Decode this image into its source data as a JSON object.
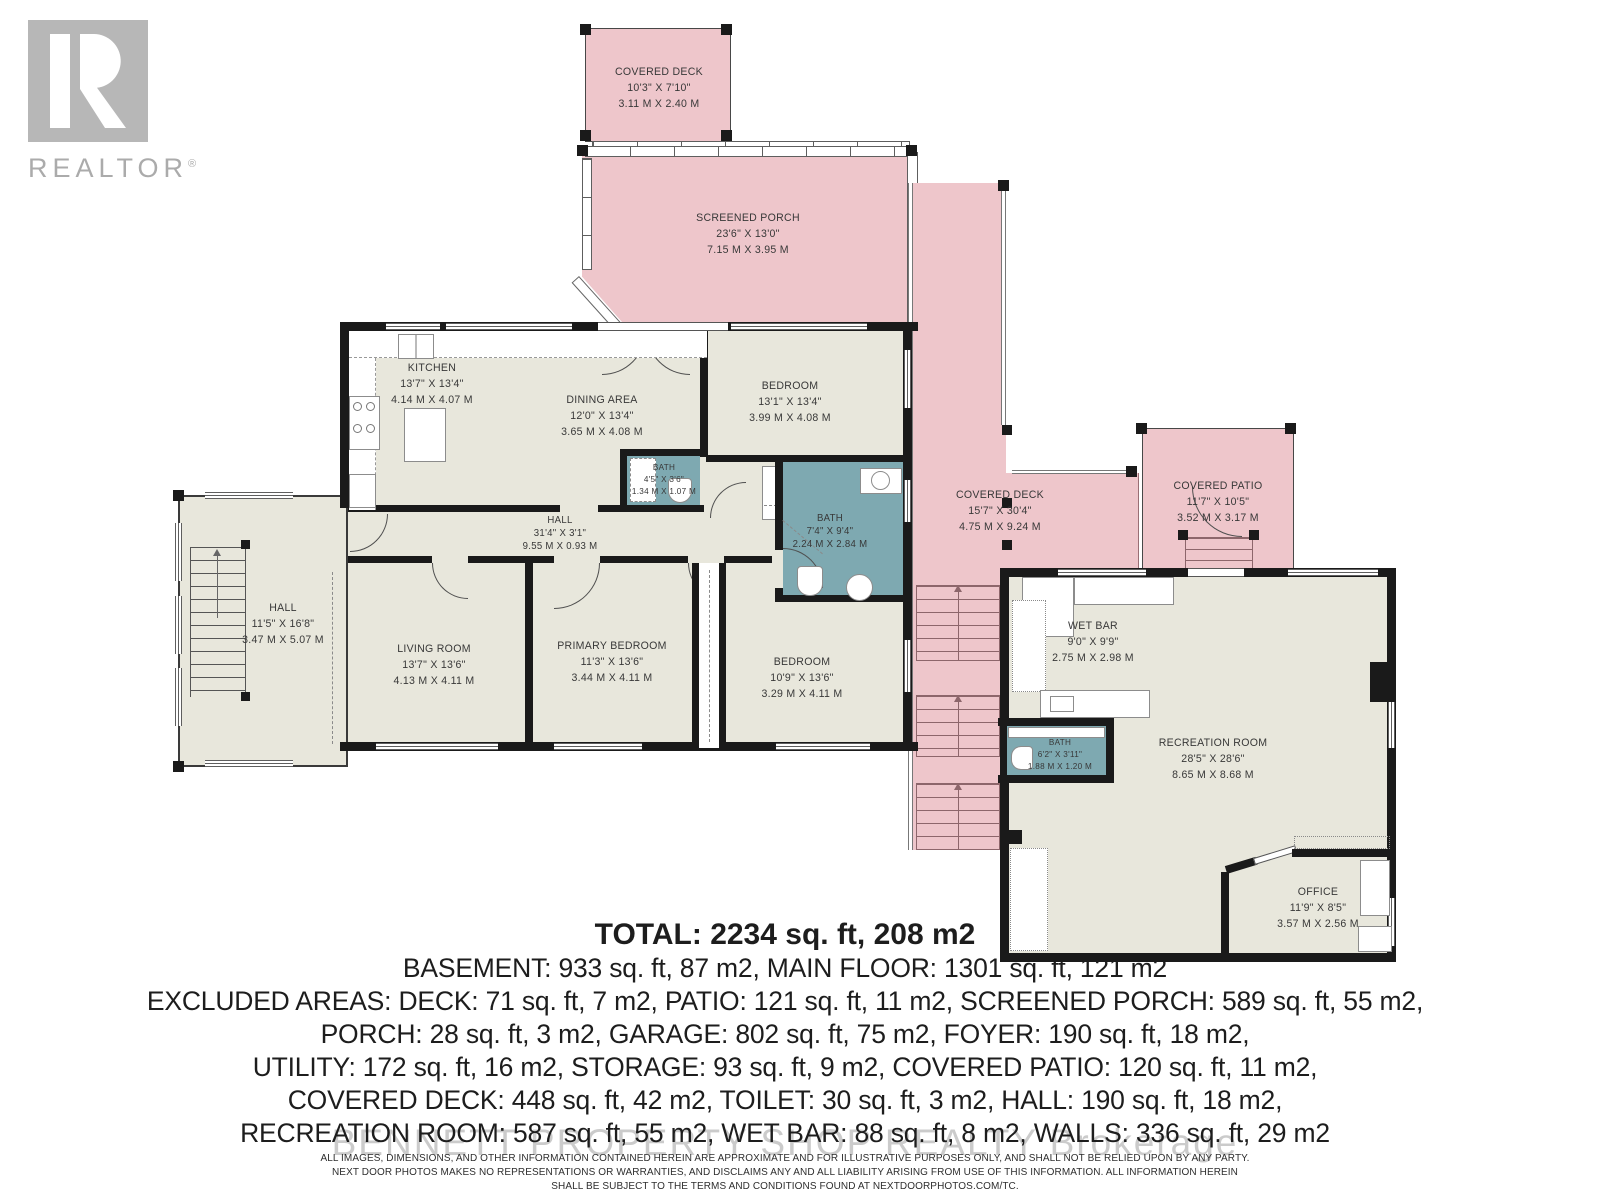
{
  "branding": {
    "logo_text": "REALTOR",
    "logo_reg": "®",
    "watermark": "BENNETT PROPERTY SHOP REALTY  Brokerage"
  },
  "colors": {
    "outdoor_pink": "#eec6cb",
    "interior_beige": "#e8e7dc",
    "bath_teal": "#7ea9b1",
    "wall_black": "#1a1a1a"
  },
  "rooms": {
    "covered_deck_top": {
      "name": "COVERED DECK",
      "dims_ft": "10'3\" X 7'10\"",
      "dims_m": "3.11 M X 2.40 M"
    },
    "screened_porch": {
      "name": "SCREENED PORCH",
      "dims_ft": "23'6\" X 13'0\"",
      "dims_m": "7.15 M X 3.95 M"
    },
    "kitchen": {
      "name": "KITCHEN",
      "dims_ft": "13'7\" X 13'4\"",
      "dims_m": "4.14 M X 4.07 M"
    },
    "dining_area": {
      "name": "DINING AREA",
      "dims_ft": "12'0\" X 13'4\"",
      "dims_m": "3.65 M X 4.08 M"
    },
    "bedroom_top": {
      "name": "BEDROOM",
      "dims_ft": "13'1\" X 13'4\"",
      "dims_m": "3.99 M X 4.08 M"
    },
    "bath_small": {
      "name": "BATH",
      "dims_ft": "4'5\" X 3'6\"",
      "dims_m": "1.34 M X 1.07 M"
    },
    "bath_main": {
      "name": "BATH",
      "dims_ft": "7'4\" X 9'4\"",
      "dims_m": "2.24 M X 2.84 M"
    },
    "hall_corridor": {
      "name": "HALL",
      "dims_ft": "31'4\" X 3'1\"",
      "dims_m": "9.55 M X 0.93 M"
    },
    "hall_left": {
      "name": "HALL",
      "dims_ft": "11'5\" X 16'8\"",
      "dims_m": "3.47 M X 5.07 M"
    },
    "living_room": {
      "name": "LIVING ROOM",
      "dims_ft": "13'7\" X 13'6\"",
      "dims_m": "4.13 M X 4.11 M"
    },
    "primary_bedroom": {
      "name": "PRIMARY BEDROOM",
      "dims_ft": "11'3\" X 13'6\"",
      "dims_m": "3.44 M X 4.11 M"
    },
    "bedroom_bottom": {
      "name": "BEDROOM",
      "dims_ft": "10'9\" X 13'6\"",
      "dims_m": "3.29 M X 4.11 M"
    },
    "covered_deck_right": {
      "name": "COVERED DECK",
      "dims_ft": "15'7\" X 30'4\"",
      "dims_m": "4.75 M X 9.24 M"
    },
    "covered_patio": {
      "name": "COVERED PATIO",
      "dims_ft": "11'7\" X 10'5\"",
      "dims_m": "3.52 M X 3.17 M"
    },
    "wet_bar": {
      "name": "WET BAR",
      "dims_ft": "9'0\" X 9'9\"",
      "dims_m": "2.75 M X 2.98 M"
    },
    "bath_basement": {
      "name": "BATH",
      "dims_ft": "6'2\" X 3'11\"",
      "dims_m": "1.88 M X 1.20 M"
    },
    "recreation_room": {
      "name": "RECREATION ROOM",
      "dims_ft": "28'5\" X 28'6\"",
      "dims_m": "8.65 M X 8.68 M"
    },
    "office": {
      "name": "OFFICE",
      "dims_ft": "11'9\" X 8'5\"",
      "dims_m": "3.57 M X 2.56 M"
    }
  },
  "summary": {
    "total": "TOTAL: 2234 sq. ft, 208 m2",
    "lines": [
      "BASEMENT: 933 sq. ft, 87 m2, MAIN FLOOR: 1301 sq. ft, 121 m2",
      "EXCLUDED AREAS: DECK: 71 sq. ft, 7 m2, PATIO: 121 sq. ft, 11 m2, SCREENED PORCH: 589 sq. ft, 55 m2,",
      "PORCH: 28 sq. ft, 3 m2, GARAGE: 802 sq. ft, 75 m2, FOYER: 190 sq. ft, 18 m2,",
      "UTILITY: 172 sq. ft, 16 m2, STORAGE: 93 sq. ft, 9 m2, COVERED PATIO: 120 sq. ft, 11 m2,",
      "COVERED DECK: 448 sq. ft, 42 m2, TOILET: 30 sq. ft, 3 m2, HALL: 190 sq. ft, 18 m2,",
      "RECREATION ROOM: 587 sq. ft, 55 m2, WET BAR: 88 sq. ft, 8 m2, WALLS: 336 sq. ft, 29 m2"
    ]
  },
  "disclaimer": {
    "lines": [
      "ALL IMAGES, DIMENSIONS, AND OTHER INFORMATION CONTAINED HEREIN ARE APPROXIMATE AND FOR ILLUSTRATIVE PURPOSES ONLY, AND SHALL NOT BE RELIED UPON BY ANY PARTY.",
      "NEXT DOOR PHOTOS MAKES NO REPRESENTATIONS OR WARRANTIES, AND DISCLAIMS ANY AND ALL LIABILITY ARISING FROM USE OF THIS INFORMATION. ALL INFORMATION HEREIN",
      "SHALL BE SUBJECT TO THE TERMS AND CONDITIONS FOUND AT NEXTDOORPHOTOS.COM/TC."
    ]
  }
}
